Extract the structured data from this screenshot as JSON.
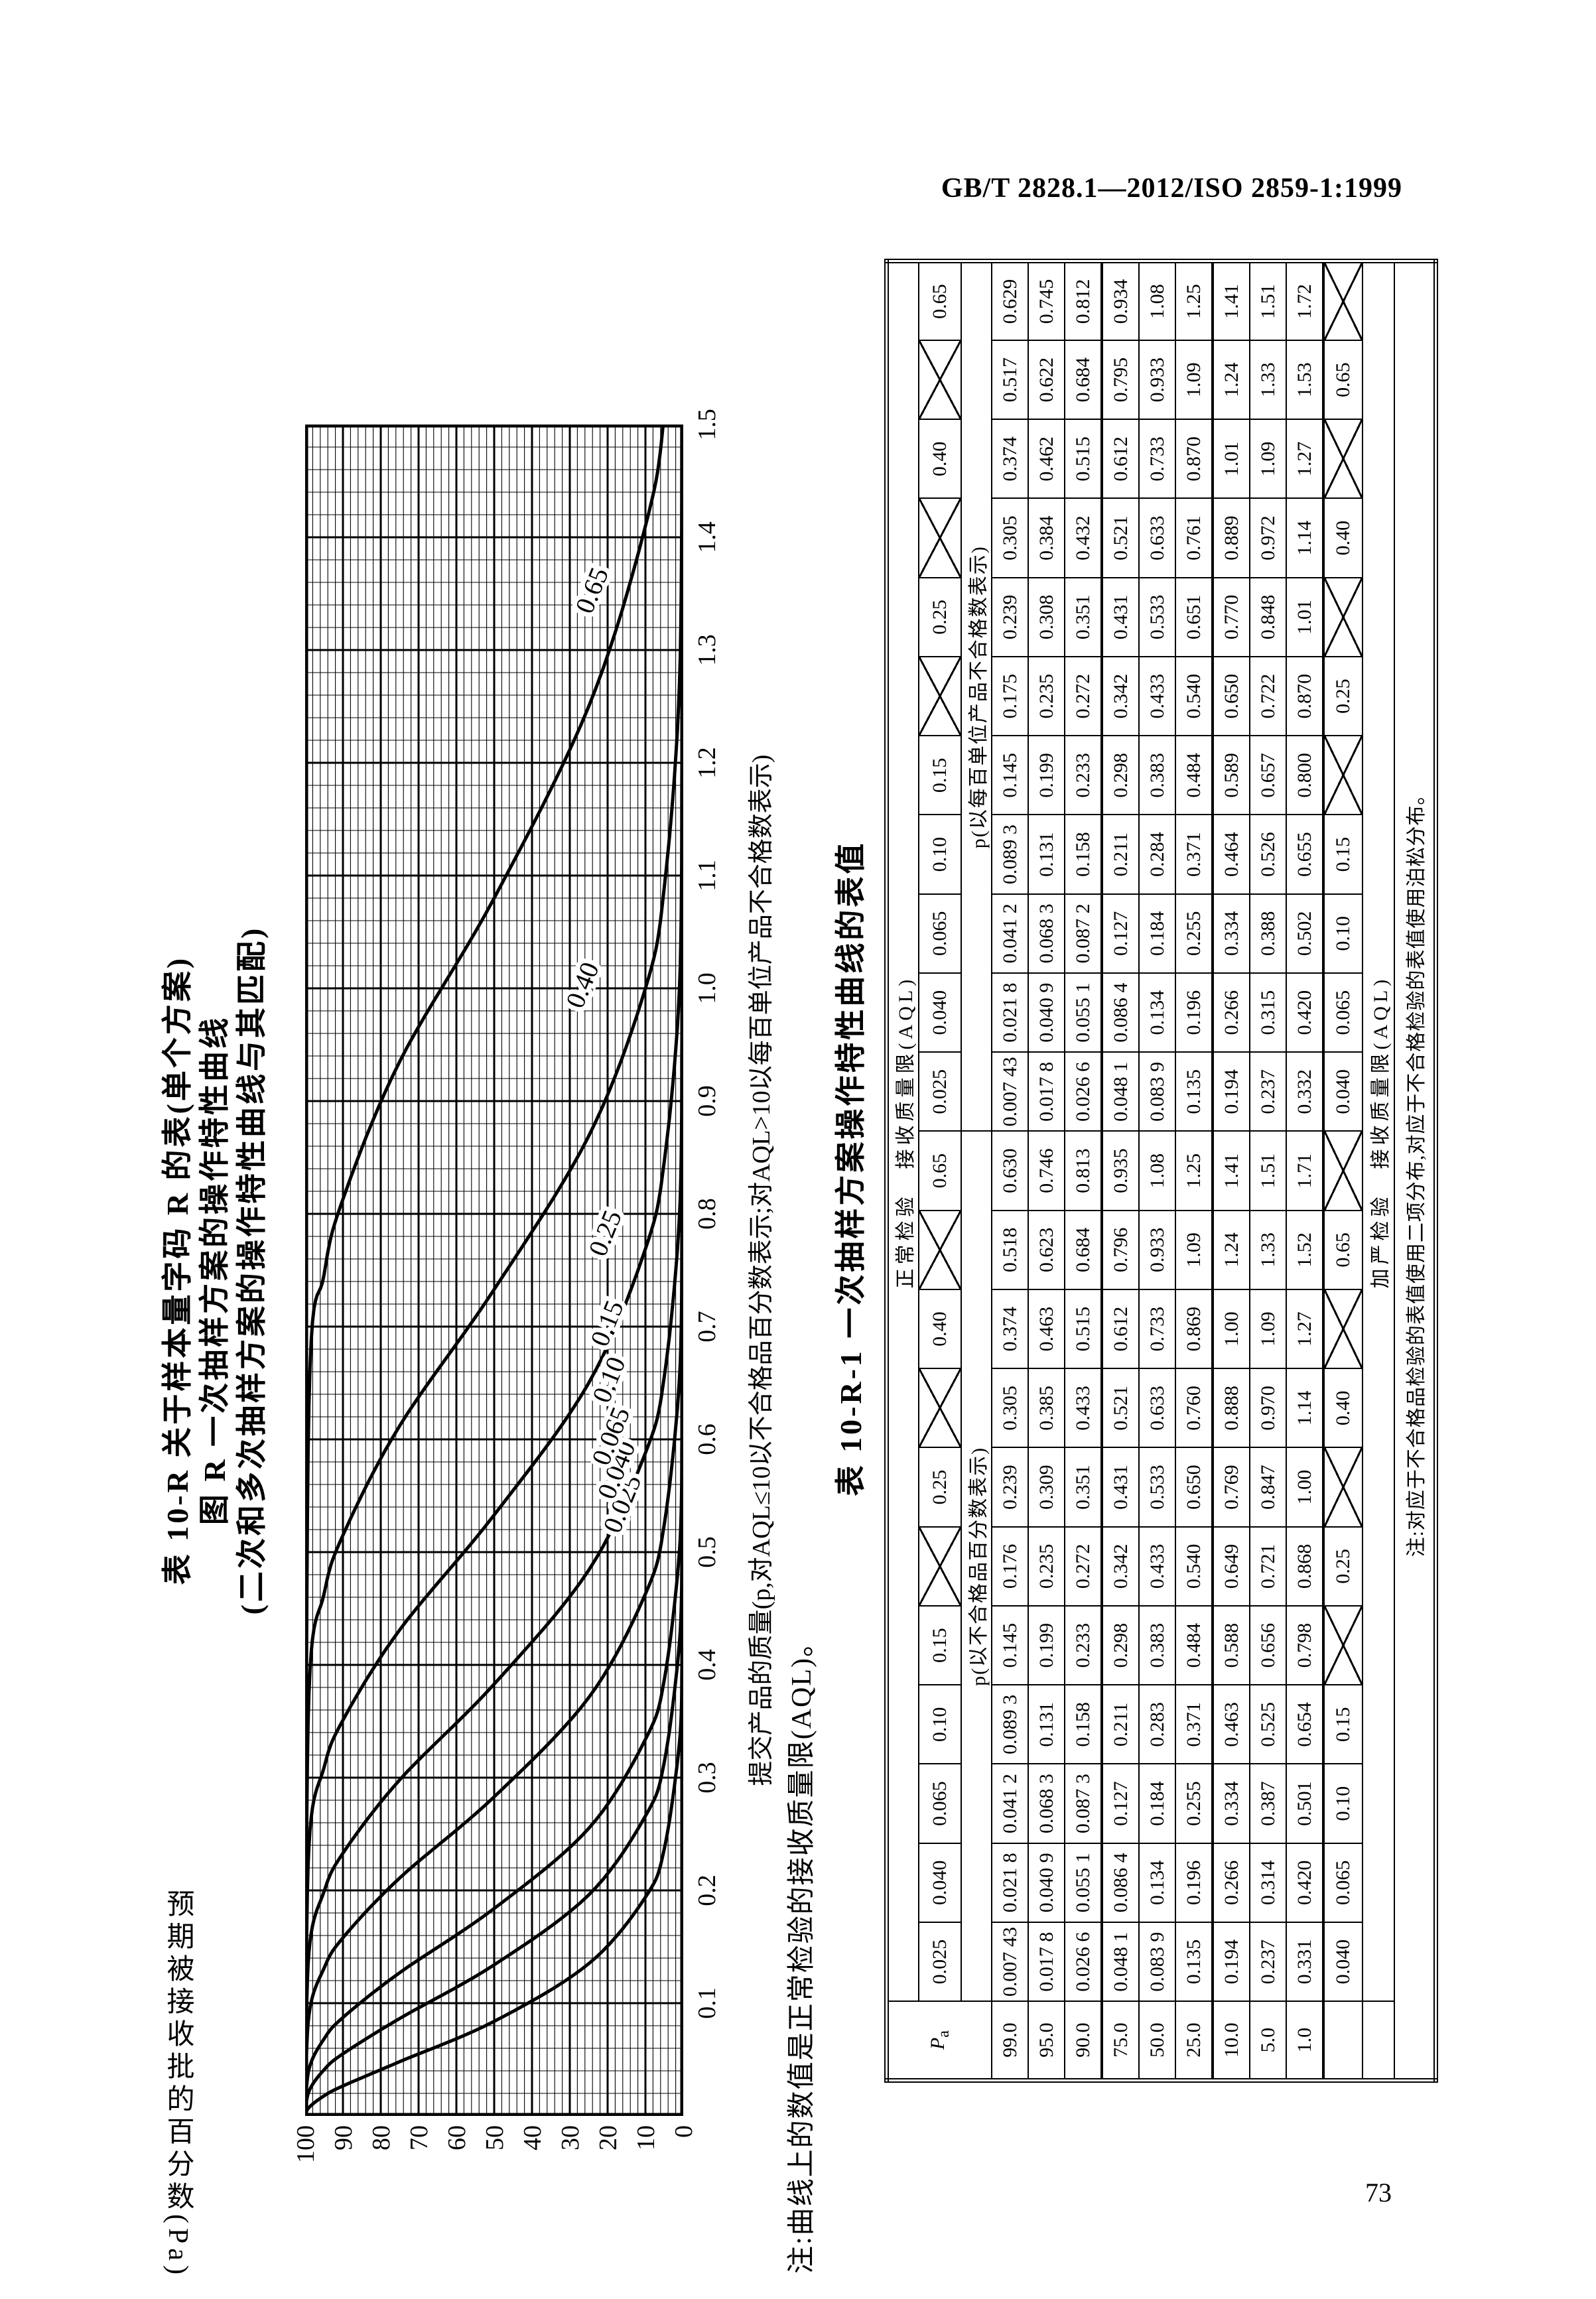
{
  "page": {
    "header": "GB/T 2828.1—2012/ISO 2859-1:1999",
    "page_number": "73"
  },
  "figure": {
    "title_line1": "表 10-R  关于样本量字码 R 的表(单个方案)",
    "title_line2": "图 R  一次抽样方案的操作特性曲线",
    "title_line3": "(二次和多次抽样方案的操作特性曲线与其匹配)",
    "y_axis_title": "预期被接收批的百分数(Pa)",
    "x_axis_title": "提交产品的质量(p,对AQL≤10以不合格品百分数表示;对AQL>10以每百单位产品不合格数表示)",
    "note": "注:曲线上的数值是正常检验的接收质量限(AQL)。"
  },
  "chart_data": {
    "type": "line",
    "title": "图 R 一次抽样方案的操作特性曲线",
    "xlabel": "提交产品的质量(p,对AQL≤10以不合格品百分数表示;对AQL>10以每百单位产品不合格数表示)",
    "ylabel": "预期被接收批的百分数(Pa)",
    "xlim": [
      0,
      1.5
    ],
    "ylim": [
      0,
      100
    ],
    "x_ticks": [
      "0.1",
      "0.2",
      "0.3",
      "0.4",
      "0.5",
      "0.6",
      "0.7",
      "0.8",
      "0.9",
      "1.0",
      "1.1",
      "1.2",
      "1.3",
      "1.4",
      "1.5"
    ],
    "y_ticks": [
      "100",
      "90",
      "80",
      "70",
      "60",
      "50",
      "40",
      "30",
      "20",
      "10",
      "0"
    ],
    "grid": {
      "minor_x": 0.02,
      "minor_y": 2,
      "major_x": 0.1,
      "major_y": 10
    },
    "legend_position": "labels-on-curves",
    "series": [
      {
        "name": "0.025",
        "label_at": [
          0.54,
          14
        ],
        "points": [
          [
            0.00743,
            99
          ],
          [
            0.0178,
            95
          ],
          [
            0.0266,
            90
          ],
          [
            0.0481,
            75
          ],
          [
            0.0839,
            50
          ],
          [
            0.135,
            25
          ],
          [
            0.194,
            10
          ],
          [
            0.237,
            5
          ],
          [
            0.331,
            1
          ]
        ]
      },
      {
        "name": "0.040",
        "label_at": [
          0.57,
          15.5
        ],
        "points": [
          [
            0.0218,
            99
          ],
          [
            0.0409,
            95
          ],
          [
            0.0551,
            90
          ],
          [
            0.0864,
            75
          ],
          [
            0.134,
            50
          ],
          [
            0.196,
            25
          ],
          [
            0.266,
            10
          ],
          [
            0.314,
            5
          ],
          [
            0.42,
            1
          ]
        ]
      },
      {
        "name": "0.065",
        "label_at": [
          0.6,
          17
        ],
        "points": [
          [
            0.0412,
            99
          ],
          [
            0.0683,
            95
          ],
          [
            0.0873,
            90
          ],
          [
            0.127,
            75
          ],
          [
            0.184,
            50
          ],
          [
            0.255,
            25
          ],
          [
            0.334,
            10
          ],
          [
            0.387,
            5
          ],
          [
            0.501,
            1
          ]
        ]
      },
      {
        "name": "0.10",
        "label_at": [
          0.65,
          17.5
        ],
        "points": [
          [
            0.0893,
            99
          ],
          [
            0.131,
            95
          ],
          [
            0.158,
            90
          ],
          [
            0.211,
            75
          ],
          [
            0.283,
            50
          ],
          [
            0.371,
            25
          ],
          [
            0.463,
            10
          ],
          [
            0.525,
            5
          ],
          [
            0.654,
            1
          ]
        ]
      },
      {
        "name": "0.15",
        "label_at": [
          0.7,
          18
        ],
        "points": [
          [
            0.145,
            99
          ],
          [
            0.199,
            95
          ],
          [
            0.233,
            90
          ],
          [
            0.298,
            75
          ],
          [
            0.383,
            50
          ],
          [
            0.484,
            25
          ],
          [
            0.588,
            10
          ],
          [
            0.656,
            5
          ],
          [
            0.798,
            1
          ]
        ]
      },
      {
        "name": "0.25",
        "label_at": [
          0.78,
          18.5
        ],
        "points": [
          [
            0.239,
            99
          ],
          [
            0.309,
            95
          ],
          [
            0.351,
            90
          ],
          [
            0.431,
            75
          ],
          [
            0.533,
            50
          ],
          [
            0.65,
            25
          ],
          [
            0.769,
            10
          ],
          [
            0.847,
            5
          ],
          [
            1.0,
            1
          ]
        ]
      },
      {
        "name": "0.40",
        "label_at": [
          1.0,
          24.5
        ],
        "points": [
          [
            0.374,
            99
          ],
          [
            0.463,
            95
          ],
          [
            0.515,
            90
          ],
          [
            0.612,
            75
          ],
          [
            0.733,
            50
          ],
          [
            0.869,
            25
          ],
          [
            1.0,
            10
          ],
          [
            1.09,
            5
          ],
          [
            1.27,
            1
          ]
        ]
      },
      {
        "name": "0.65",
        "label_at": [
          1.35,
          22
        ],
        "points": [
          [
            0.63,
            99
          ],
          [
            0.746,
            95
          ],
          [
            0.813,
            90
          ],
          [
            0.935,
            75
          ],
          [
            1.08,
            50
          ],
          [
            1.25,
            25
          ],
          [
            1.41,
            10
          ],
          [
            1.51,
            5
          ],
          [
            1.71,
            1
          ]
        ]
      }
    ]
  },
  "table": {
    "title": "表 10-R-1  一次抽样方案操作特性曲线的表值",
    "header_normal": "正常检验　接收质量限(AQL)",
    "header_tightened": "加严检验　接收质量限(AQL)",
    "pa_label": "Pa",
    "section_left_label": "p(以不合格品百分数表示)",
    "section_right_label": "p(以每百单位产品不合格数表示)",
    "pa_rows": [
      "99.0",
      "95.0",
      "90.0",
      "75.0",
      "50.0",
      "25.0",
      "10.0",
      "5.0",
      "1.0"
    ],
    "columns": [
      {
        "aql": "0.025",
        "tightened": "0.040",
        "values": [
          "0.007 43",
          "0.017 8",
          "0.026 6",
          "0.048 1",
          "0.083 9",
          "0.135",
          "0.194",
          "0.237",
          "0.331"
        ]
      },
      {
        "aql": "0.040",
        "tightened": "0.065",
        "values": [
          "0.021 8",
          "0.040 9",
          "0.055 1",
          "0.086 4",
          "0.134",
          "0.196",
          "0.266",
          "0.314",
          "0.420"
        ]
      },
      {
        "aql": "0.065",
        "tightened": "0.10",
        "values": [
          "0.041 2",
          "0.068 3",
          "0.087 3",
          "0.127",
          "0.184",
          "0.255",
          "0.334",
          "0.387",
          "0.501"
        ]
      },
      {
        "aql": "0.10",
        "tightened": "0.15",
        "values": [
          "0.089 3",
          "0.131",
          "0.158",
          "0.211",
          "0.283",
          "0.371",
          "0.463",
          "0.525",
          "0.654"
        ]
      },
      {
        "aql": "0.15",
        "tightened": "X",
        "values": [
          "0.145",
          "0.199",
          "0.233",
          "0.298",
          "0.383",
          "0.484",
          "0.588",
          "0.656",
          "0.798"
        ]
      },
      {
        "aql": null,
        "tightened": "0.25",
        "values": [
          "0.176",
          "0.235",
          "0.272",
          "0.342",
          "0.433",
          "0.540",
          "0.649",
          "0.721",
          "0.868"
        ]
      },
      {
        "aql": "0.25",
        "tightened": "X",
        "values": [
          "0.239",
          "0.309",
          "0.351",
          "0.431",
          "0.533",
          "0.650",
          "0.769",
          "0.847",
          "1.00"
        ]
      },
      {
        "aql": null,
        "tightened": "0.40",
        "values": [
          "0.305",
          "0.385",
          "0.433",
          "0.521",
          "0.633",
          "0.760",
          "0.888",
          "0.970",
          "1.14"
        ]
      },
      {
        "aql": "0.40",
        "tightened": "X",
        "values": [
          "0.374",
          "0.463",
          "0.515",
          "0.612",
          "0.733",
          "0.869",
          "1.00",
          "1.09",
          "1.27"
        ]
      },
      {
        "aql": null,
        "tightened": "0.65",
        "values": [
          "0.518",
          "0.623",
          "0.684",
          "0.796",
          "0.933",
          "1.09",
          "1.24",
          "1.33",
          "1.52"
        ]
      },
      {
        "aql": "0.65",
        "tightened": "X",
        "values": [
          "0.630",
          "0.746",
          "0.813",
          "0.935",
          "1.08",
          "1.25",
          "1.41",
          "1.51",
          "1.71"
        ]
      },
      {
        "aql": "0.025",
        "tightened": "0.040",
        "values": [
          "0.007 43",
          "0.017 8",
          "0.026 6",
          "0.048 1",
          "0.083 9",
          "0.135",
          "0.194",
          "0.237",
          "0.332"
        ]
      },
      {
        "aql": "0.040",
        "tightened": "0.065",
        "values": [
          "0.021 8",
          "0.040 9",
          "0.055 1",
          "0.086 4",
          "0.134",
          "0.196",
          "0.266",
          "0.315",
          "0.420"
        ]
      },
      {
        "aql": "0.065",
        "tightened": "0.10",
        "values": [
          "0.041 2",
          "0.068 3",
          "0.087 2",
          "0.127",
          "0.184",
          "0.255",
          "0.334",
          "0.388",
          "0.502"
        ]
      },
      {
        "aql": "0.10",
        "tightened": "0.15",
        "values": [
          "0.089 3",
          "0.131",
          "0.158",
          "0.211",
          "0.284",
          "0.371",
          "0.464",
          "0.526",
          "0.655"
        ]
      },
      {
        "aql": "0.15",
        "tightened": "X",
        "values": [
          "0.145",
          "0.199",
          "0.233",
          "0.298",
          "0.383",
          "0.484",
          "0.589",
          "0.657",
          "0.800"
        ]
      },
      {
        "aql": null,
        "tightened": "0.25",
        "values": [
          "0.175",
          "0.235",
          "0.272",
          "0.342",
          "0.433",
          "0.540",
          "0.650",
          "0.722",
          "0.870"
        ]
      },
      {
        "aql": "0.25",
        "tightened": "X",
        "values": [
          "0.239",
          "0.308",
          "0.351",
          "0.431",
          "0.533",
          "0.651",
          "0.770",
          "0.848",
          "1.01"
        ]
      },
      {
        "aql": null,
        "tightened": "0.40",
        "values": [
          "0.305",
          "0.384",
          "0.432",
          "0.521",
          "0.633",
          "0.761",
          "0.889",
          "0.972",
          "1.14"
        ]
      },
      {
        "aql": "0.40",
        "tightened": "X",
        "values": [
          "0.374",
          "0.462",
          "0.515",
          "0.612",
          "0.733",
          "0.870",
          "1.01",
          "1.09",
          "1.27"
        ]
      },
      {
        "aql": null,
        "tightened": "0.65",
        "values": [
          "0.517",
          "0.622",
          "0.684",
          "0.795",
          "0.933",
          "1.09",
          "1.24",
          "1.33",
          "1.53"
        ]
      },
      {
        "aql": "0.65",
        "tightened": "X",
        "values": [
          "0.629",
          "0.745",
          "0.812",
          "0.934",
          "1.08",
          "1.25",
          "1.41",
          "1.51",
          "1.72"
        ]
      }
    ],
    "note": "注:对应于不合格品检验的表值使用二项分布,对应于不合格检验的表值使用泊松分布。"
  }
}
